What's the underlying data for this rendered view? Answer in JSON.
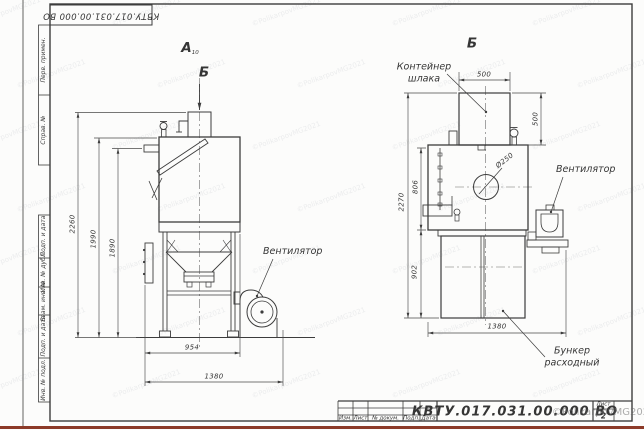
{
  "frame": {
    "designation_stamp": "КВТУ.017.031.00.000 ВО",
    "margin_top_cells": [
      "Перв. примен.",
      "Справ. №"
    ],
    "margin_bottom_cells": [
      "Подп. и дата",
      "Инв. № дубл.",
      "Взам. инв. №",
      "Подп. и дата",
      "Инв. № подл."
    ]
  },
  "title_block": {
    "designation": "КВТУ.017.031.00.000  ВО",
    "columns": [
      "Изм.",
      "Лист",
      "№ докум.",
      "Подп.",
      "Дата"
    ],
    "sheet_label": "Лист",
    "sheet_number": "2"
  },
  "watermark": {
    "copyright": "©PolikarpovMG2021"
  },
  "view_a": {
    "title": "А",
    "title_sub": "10",
    "section_mark": "Б",
    "labels": {
      "fan": "Вентилятор"
    },
    "dims": {
      "overall_height": "2260",
      "body_height": "1990",
      "inner_height": "1890",
      "body_width": "954",
      "overall_width": "1380"
    }
  },
  "view_b": {
    "title": "Б",
    "labels": {
      "container_line1": "Контейнер",
      "container_line2": "шлака",
      "fan": "Вентилятор",
      "bunker_line1": "Бункер",
      "bunker_line2": "расходный"
    },
    "dims": {
      "container_width": "500",
      "container_height": "500",
      "overall_height": "2270",
      "body_height": "806",
      "bunker_height": "902",
      "overall_width": "1380",
      "hole_diameter": "Ø250"
    }
  }
}
